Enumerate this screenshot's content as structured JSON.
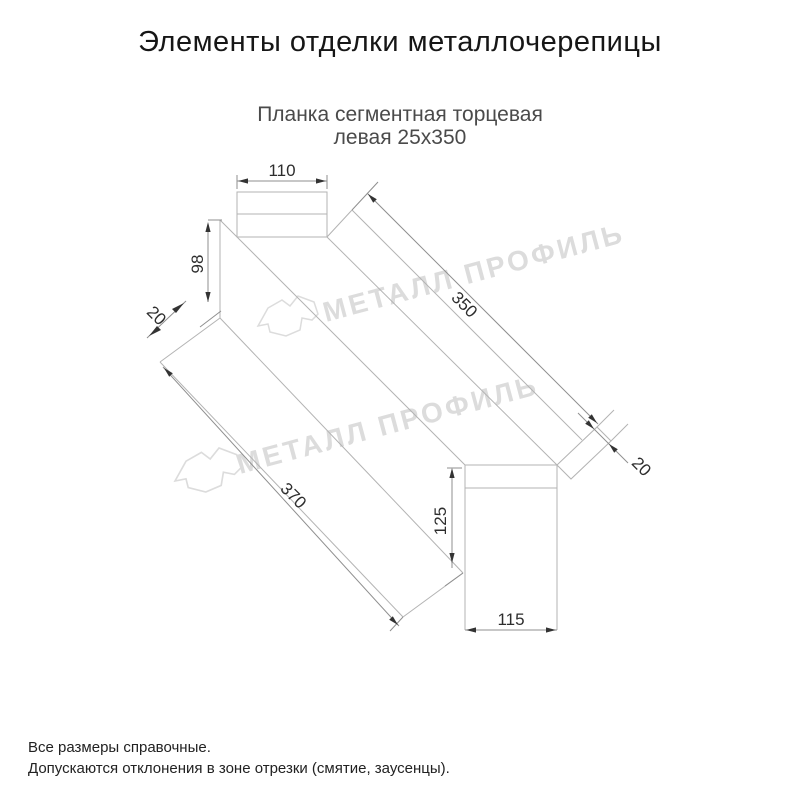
{
  "page_title": "Элементы отделки металлочерепицы",
  "product": {
    "name_line1": "Планка сегментная торцевая",
    "name_line2": "левая 25х350"
  },
  "drawing": {
    "dimensions": {
      "top_flange_width": "110",
      "web_height": "98",
      "left_fold_width": "20",
      "top_edge_length": "350",
      "bottom_edge_length": "370",
      "end_face_height": "125",
      "end_face_width": "115",
      "right_fold_width": "20"
    },
    "watermark": {
      "text": "МЕТАЛЛ ПРОФИЛЬ"
    }
  },
  "notes": {
    "line1": "Все размеры справочные.",
    "line2": "Допускаются отклонения в зоне отрезки (смятие, заусенцы)."
  },
  "colors": {
    "background": "#ffffff",
    "edge_line": "#b3b3b3",
    "dimension_line": "#8f8f8f",
    "dimension_text": "#2d2d2d",
    "arrow": "#333333",
    "title_text": "#161616",
    "subtitle_text": "#4a4a4a",
    "watermark": "#dcdcdc"
  }
}
